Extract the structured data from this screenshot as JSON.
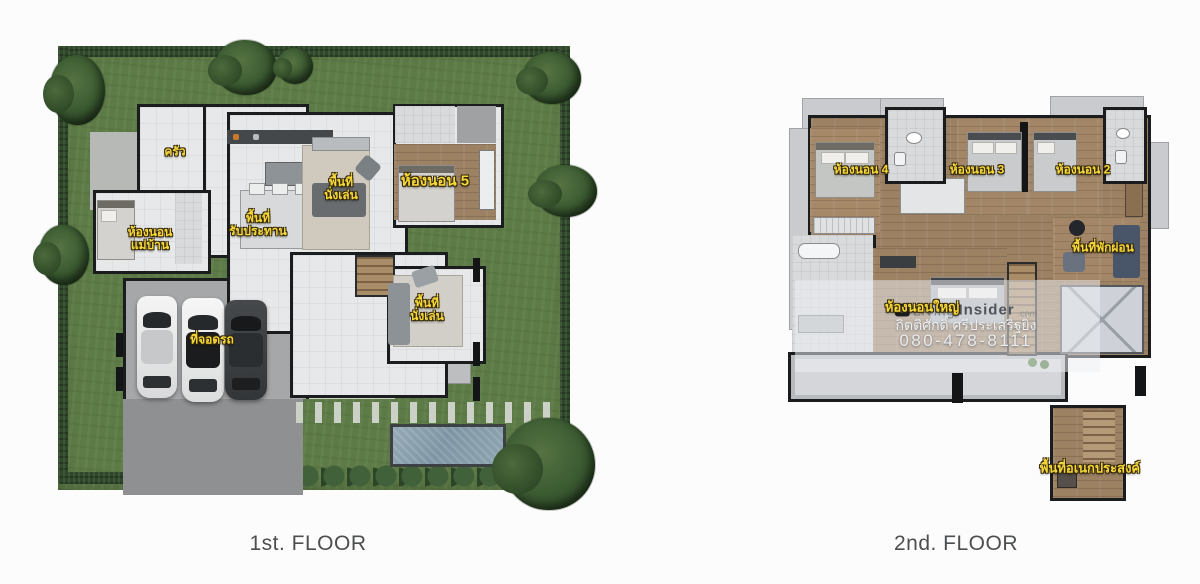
{
  "floor1": {
    "caption": "1st. FLOOR",
    "labels": {
      "kitchen": "ครัว",
      "living_top_line1": "พื้นที่",
      "living_top_line2": "นั่งเล่น",
      "bedroom5": "ห้องนอน 5",
      "dining_line1": "พื้นที่",
      "dining_line2": "รับประทาน",
      "maid_line1": "ห้องนอน",
      "maid_line2": "แม่บ้าน",
      "parking": "ที่จอดรถ",
      "living_bottom_line1": "พื้นที่",
      "living_bottom_line2": "นั่งเล่น"
    }
  },
  "floor2": {
    "caption": "2nd. FLOOR",
    "labels": {
      "bedroom4": "ห้องนอน 4",
      "bedroom3": "ห้องนอน 3",
      "bedroom2": "ห้องนอน 2",
      "relax_area": "พื้นที่พักผ่อน",
      "master_bedroom": "ห้องนอนใหญ่",
      "multipurpose": "พื้นที่อเนกประสงค์"
    },
    "watermark": {
      "logo_text": "in",
      "brand_word1": "Living",
      "brand_word2": "Insider",
      "domain": ".com",
      "agent_name": "กิตติศักดิ์ ศรีประเสริฐยิ่ง",
      "phone": "080-478-8111"
    }
  },
  "colors": {
    "lawn": "#5d7b46",
    "hedge": "#2f4829",
    "wall": "#1b1c1e",
    "wood": "#9c8163",
    "label_yellow": "#f6d73b"
  }
}
